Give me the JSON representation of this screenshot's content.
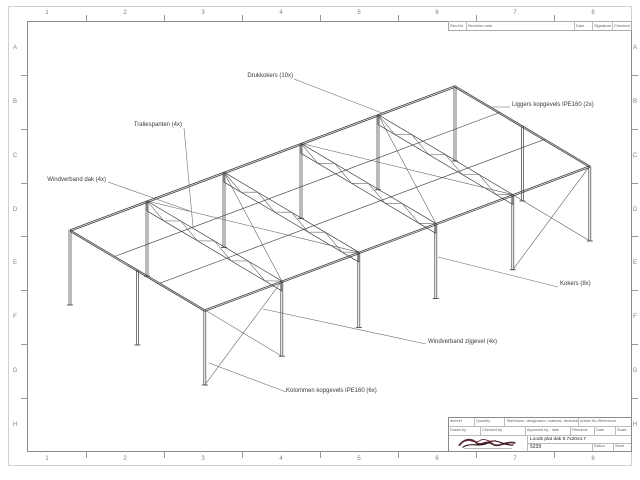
{
  "sheet": {
    "grid_columns": [
      "1",
      "2",
      "3",
      "4",
      "5",
      "6",
      "7",
      "8"
    ],
    "grid_rows": [
      "A",
      "B",
      "C",
      "D",
      "E",
      "F",
      "G",
      "H"
    ]
  },
  "revision_table": {
    "headers": [
      "Rev.No",
      "Revision note",
      "Date",
      "Signature",
      "Checked"
    ]
  },
  "annotations": [
    {
      "text": "Drukkokers (10x)"
    },
    {
      "text": "Traliespanten (4x)"
    },
    {
      "text": "Windverband dak (4x)"
    },
    {
      "text": "Liggers kopgevels IPE160 (2x)"
    },
    {
      "text": "Kokers (8x)"
    },
    {
      "text": "Windverband zijgevel (4x)"
    },
    {
      "text": "Kolommen kopgevels IPE160 (6x)"
    }
  ],
  "title_block": {
    "row1": [
      "Itemref",
      "Quantity",
      "Title/Name, designation, material, dimension etc",
      "Article No./Reference"
    ],
    "row2": [
      "Drawn by",
      "Checked by",
      "Approved by - date",
      "Filename",
      "Date",
      "Scale"
    ],
    "drawing_title": "Loods plat dak 9.7x20x4.7",
    "drawing_number": "5239",
    "edition_label": "Edition",
    "sheet_label": "Sheet"
  },
  "structure": {
    "length_m": 20,
    "width_m": 9.7,
    "height_m": 4.7,
    "truss_positions_m": [
      4,
      8,
      12,
      16
    ],
    "gable_column_positions_m": [
      0,
      4.85,
      9.7
    ],
    "drukkoker_positions_m": [
      3.23,
      6.47
    ],
    "roof_brace_bays": [
      [
        4,
        8
      ],
      [
        12,
        16
      ]
    ],
    "wall_brace_bays": [
      [
        0,
        4
      ],
      [
        16,
        20
      ]
    ]
  }
}
